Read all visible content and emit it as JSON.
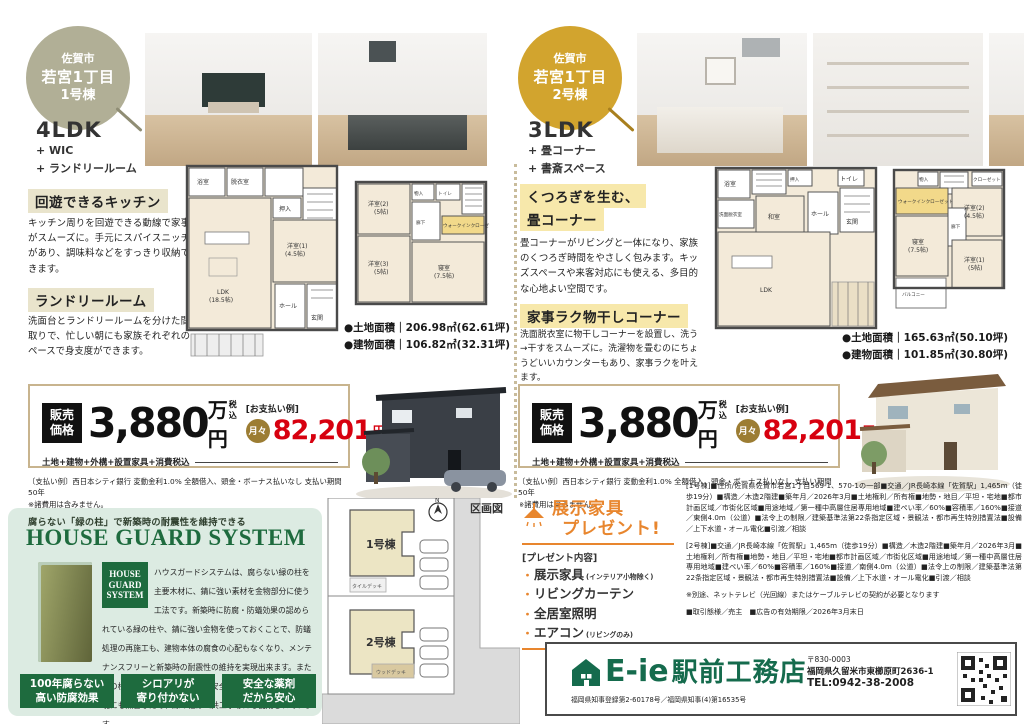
{
  "left": {
    "badge": {
      "line1": "佐賀市",
      "line2": "若宮1丁目",
      "line3": "1号棟"
    },
    "plan_type": "4LDK",
    "features": [
      "+ WIC",
      "+ ランドリールーム"
    ],
    "sections": [
      {
        "title": "回遊できるキッチン",
        "body": "キッチン周りを回遊できる動線で家事がスムーズに。手元にスパイスニッチがあり、調味料などをすっきり収納できます。"
      },
      {
        "title": "ランドリールーム",
        "body": "洗面台とランドリールームを分けた間取りで、忙しい朝にも家族それぞれのペースで身支度ができます。"
      }
    ],
    "area_land": "●土地面積｜206.98㎡(62.61坪)",
    "area_building": "●建物面積｜106.82㎡(32.31坪)",
    "plan1f_rooms": [
      "浴室",
      "脱衣室",
      "押入",
      "LDK",
      "(18.5帖)",
      "洋室(1)",
      "(4.5帖)",
      "ホール",
      "玄関"
    ],
    "plan2f_rooms": [
      "物入",
      "トイレ",
      "洋室(2)",
      "(5帖)",
      "廊下",
      "ウォークインクローゼット",
      "洋室(3)",
      "(5帖)",
      "寝室",
      "(7.5帖)"
    ]
  },
  "right": {
    "badge": {
      "line1": "佐賀市",
      "line2": "若宮1丁目",
      "line3": "2号棟"
    },
    "plan_type": "3LDK",
    "features": [
      "+ 畳コーナー",
      "+ 書斎スペース"
    ],
    "sections": [
      {
        "title_line1": "くつろぎを生む、",
        "title_line2": "畳コーナー",
        "body": "畳コーナーがリビングと一体になり、家族のくつろぎ時間をやさしく包みます。キッズスペースや来客対応にも使える、多目的な心地よい空間です。"
      },
      {
        "title": "家事ラク物干しコーナー",
        "body": "洗面脱衣室に物干しコーナーを設置し、洗う→干すをスムーズに。洗濯物を畳むのにちょうどいいカウンターもあり、家事ラクを叶えます。"
      }
    ],
    "area_land": "●土地面積｜165.63㎡(50.10坪)",
    "area_building": "●建物面積｜101.85㎡(30.80坪)",
    "plan1f_rooms": [
      "浴室",
      "洗面脱衣室",
      "押入",
      "和室",
      "LDK",
      "ホール",
      "玄関",
      "トイレ"
    ],
    "plan2f_rooms": [
      "物入",
      "クローゼット",
      "洋室(2)",
      "(4.5帖)",
      "廊下",
      "ウォークインクローゼット",
      "寝室",
      "(7.5帖)",
      "洋室(1)",
      "(5帖)",
      "バルコニー"
    ]
  },
  "price": {
    "label_line1": "販売",
    "label_line2": "価格",
    "amount": "3,880",
    "unit": "万円",
    "tax": "税込",
    "includes": "土地+建物+外構+設置家具+消費税込",
    "example_label": "[お支払い例]",
    "monthly_prefix": "月々",
    "monthly_amount": "82,201",
    "monthly_unit": "円"
  },
  "payment_note_line1": "〔支払い例〕西日本シティ銀行 変動金利1.0% 全額借入、頭金・ボーナス払いなし 支払い期間50年",
  "payment_note_line2": "※諸費用は含みません。",
  "house_guard": {
    "tagline": "腐らない「緑の柱」で新築時の耐震性を維持できる",
    "title": "HOUSE GUARD SYSTEM",
    "badge_lines": [
      "HOUSE",
      "GUARD",
      "SYSTEM"
    ],
    "body": "ハウスガードシステムは、腐らない緑の柱を主要木材に、錆に強い素材を金物部分に使う工法です。新築時に防腐・防蟻効果の認められている緑の柱や、錆に強い金物を使っておくことで、防蟻処理の再施工も、建物本体の腐食の心配もなくなり、メンテナンスフリーと新築時の耐震性の維持を実現出来ます。また緑の柱に使用されている薬剤は安全性が実証されており、環境にも無害なため、緑の柱は公共工事等にも使用されています。",
    "note": "※10年目床下部分の白蟻予防簡易施工(有償)のみ必要",
    "badges": [
      {
        "line1": "100年腐らない",
        "line2": "高い防腐効果"
      },
      {
        "line1": "シロアリが",
        "line2": "寄り付かない"
      },
      {
        "line1": "安全な薬剤",
        "line2": "だから安心"
      }
    ]
  },
  "plot_map": {
    "title": "区画図",
    "compass": "N",
    "lot1_label": "1号棟",
    "lot1_deck": "タイルデッキ",
    "lot2_label": "2号棟",
    "lot2_deck": "ウッドデッキ"
  },
  "present": {
    "title_line1": "展示家具",
    "title_line2": "プレゼント!",
    "contents_label": "[プレゼント内容]",
    "items": [
      {
        "label": "展示家具",
        "note": "(インテリア小物除く)"
      },
      {
        "label": "リビングカーテン",
        "note": ""
      },
      {
        "label": "全居室照明",
        "note": ""
      },
      {
        "label": "エアコン",
        "note": "(リビングのみ)"
      }
    ]
  },
  "legal": {
    "unit1": "[1号棟]■住所/佐賀県佐賀市若宮1丁目569-1、570-1の一部■交通／JR長崎本線「佐賀駅」1,465m（徒歩19分）■構造／木造2階建■築年月／2026年3月■土地権利／所有権■地勢・地目／平坦・宅地■都市計画区域／市街化区域■用途地域／第一種中高層住居専用地域■建ぺい率／60%■容積率／160%■接道／東側4.0m（公道）■法令上の制限／建築基準法第22条指定区域・景観法・都市再生特別措置法■設備／上下水道・オール電化■引渡／相談",
    "unit2": "[2号棟]■交通／JR長崎本線「佐賀駅」1,465m（徒歩19分）■構造／木造2階建■築年月／2026年3月■土地権利／所有権■地勢・地目／平坦・宅地■都市計画区域／市街化区域■用途地域／第一種中高層住居専用地域■建ぺい率／60%■容積率／160%■接道／南側4.0m（公道）■法令上の制限／建築基準法第22条指定区域・景観法・都市再生特別措置法■設備／上下水道・オール電化■引渡／相談",
    "note": "※別途、ネットテレビ（光回線）またはケーブルテレビの契約が必要となります",
    "deal": "■取引態様／売主　■広告の有効期限／2026年3月末日"
  },
  "company": {
    "name_main": "E-ie",
    "name_sub": "駅前工務店",
    "license": "福岡県知事登録第2-60178号／福岡県知事(4)第16535号",
    "zip": "〒830-0003",
    "address": "福岡県久留米市東櫛原町2636-1",
    "tel": "TEL:0942-38-2008"
  }
}
